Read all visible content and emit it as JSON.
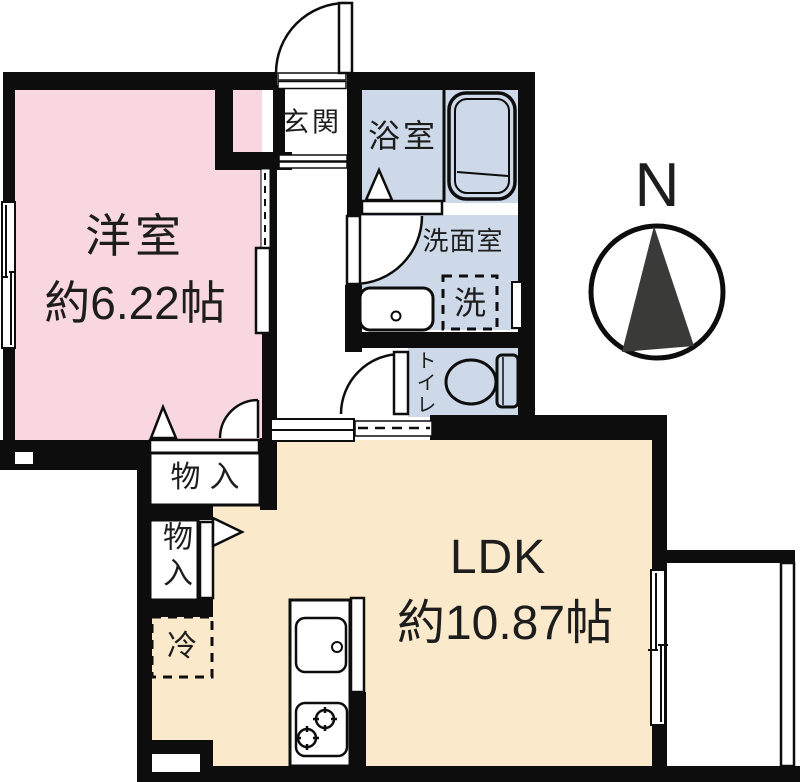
{
  "floorplan": {
    "compass": {
      "north_label": "N"
    },
    "rooms": {
      "western_room": {
        "name": "洋室",
        "size": "約6.22帖"
      },
      "ldk": {
        "name": "LDK",
        "size": "約10.87帖"
      },
      "entrance": {
        "label": "玄関"
      },
      "bathroom": {
        "label": "浴室"
      },
      "washroom": {
        "label": "洗面室"
      },
      "toilet": {
        "label": "トイレ"
      },
      "laundry_space": {
        "label": "洗"
      },
      "storage_upper": {
        "label": "物入"
      },
      "storage_lower": {
        "label": "物入"
      },
      "refrigerator_space": {
        "label": "冷"
      }
    },
    "colors": {
      "wall": "#0d0d0d",
      "western_room_fill": "#f8d7e0",
      "wet_area_fill": "#cdd9e8",
      "ldk_fill": "#fae9cb",
      "compass_needle": "#3a3a38",
      "text": "#1d1d1d"
    }
  }
}
